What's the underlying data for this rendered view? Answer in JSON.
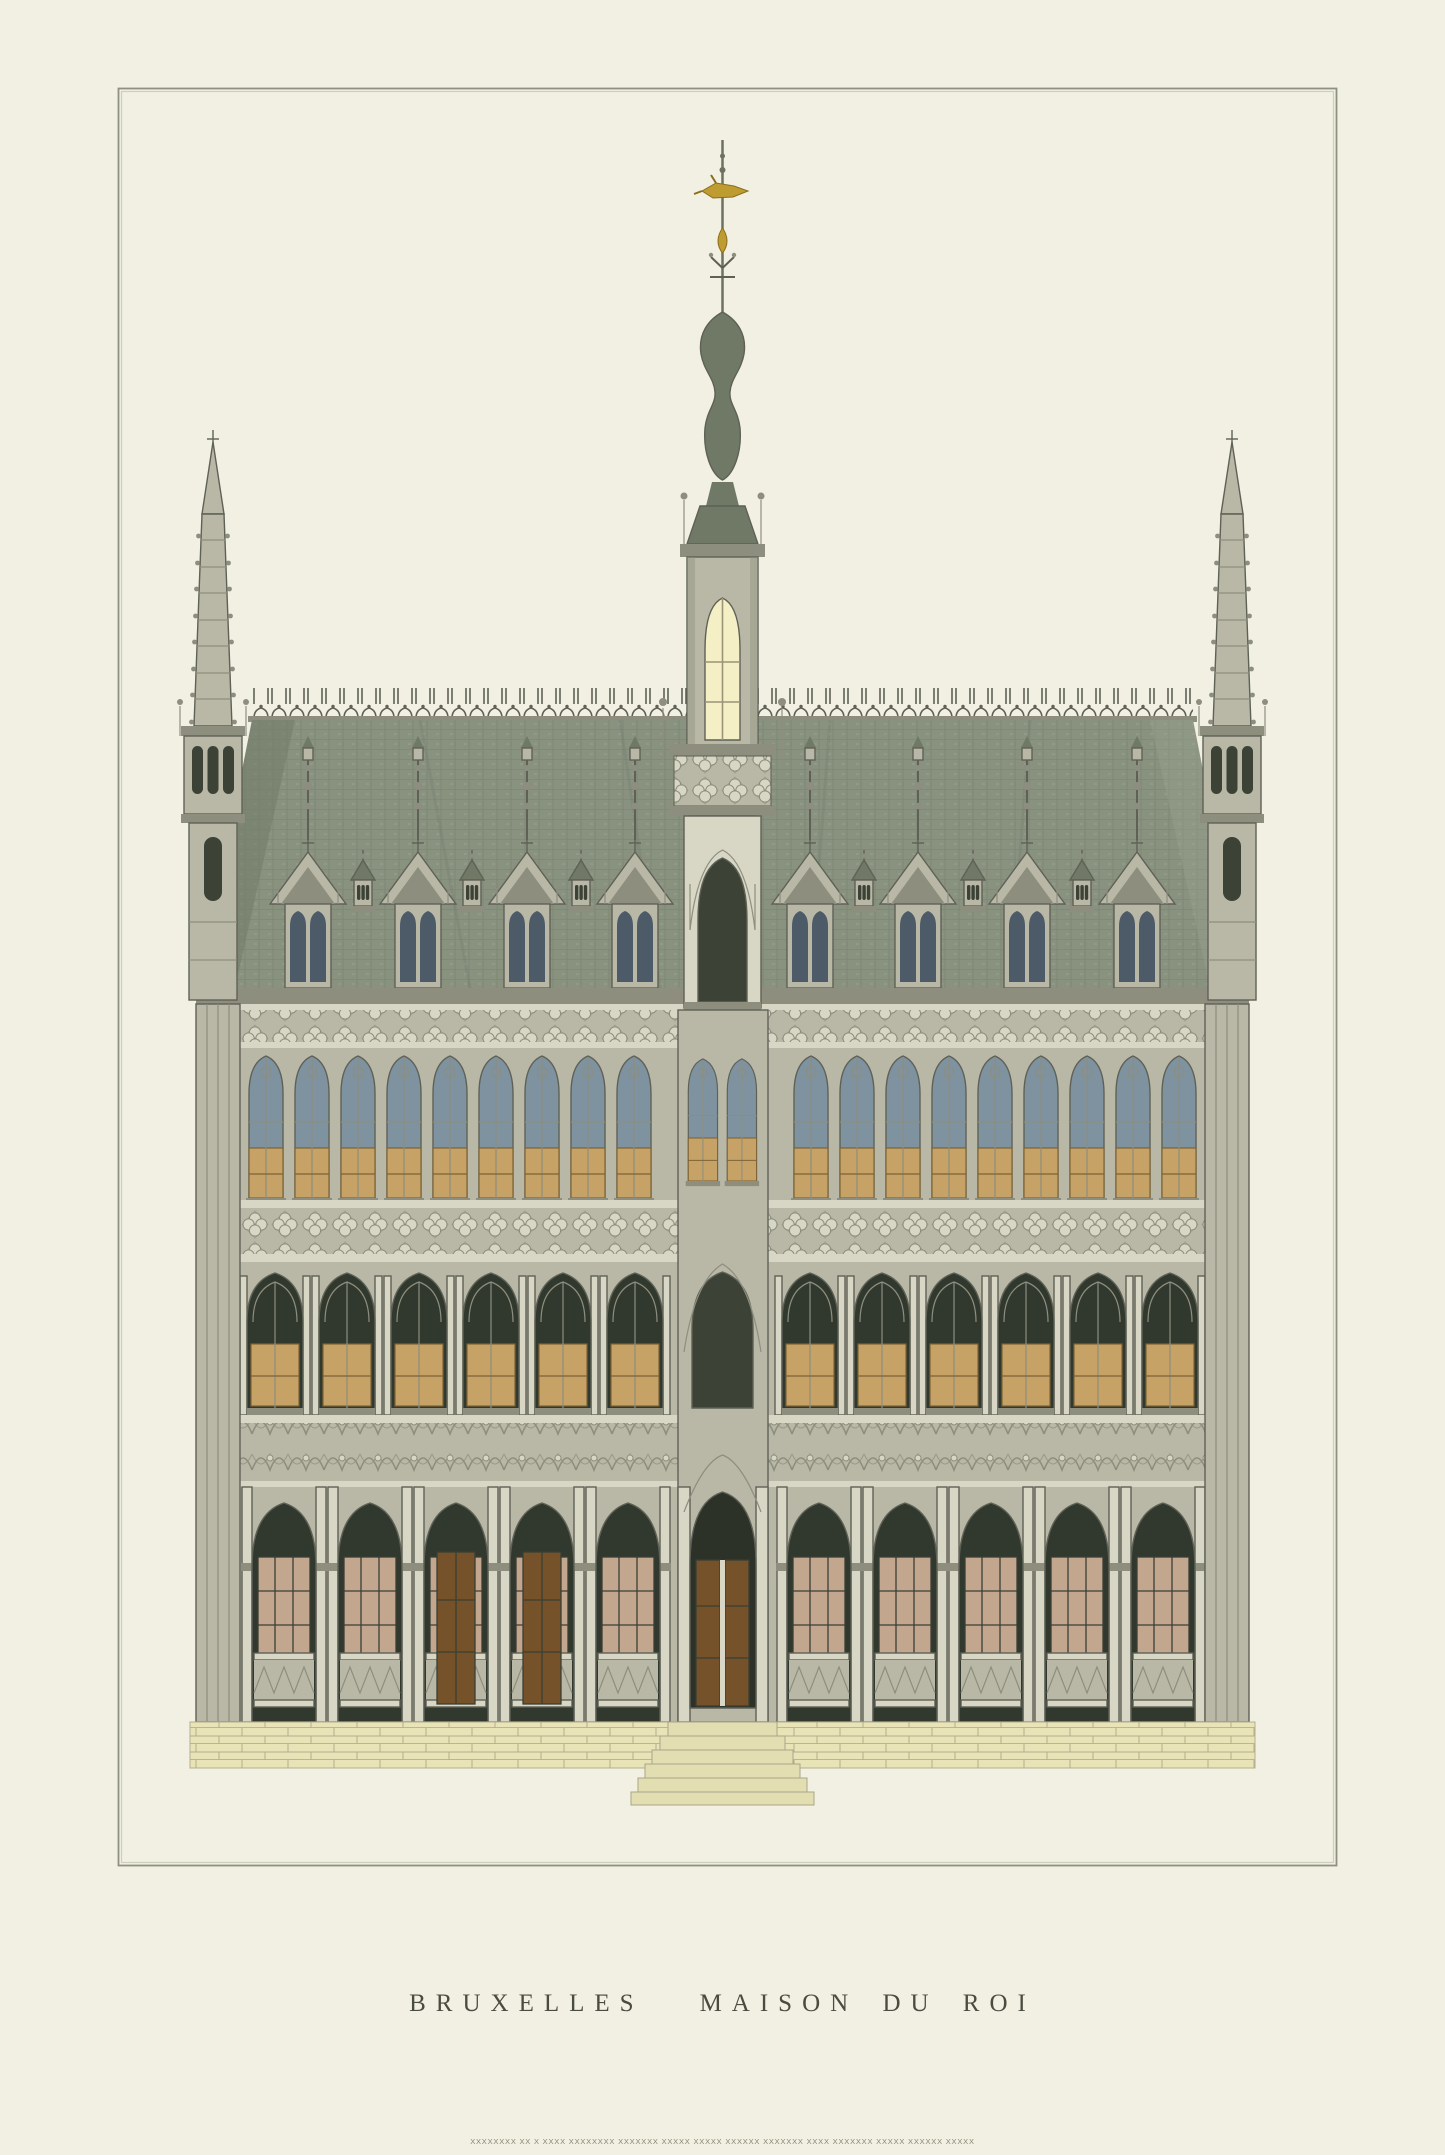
{
  "print": {
    "caption_left": "BRUXELLES",
    "caption_right": "MAISON DU ROI",
    "fine_print_illegible": "XXXXXXXX XX X XXXX XXXXXXXX XXXXXXX XXXXX XXXXX XXXXXX XXXXXXX XXXX XXXXXXX XXXXX XXXXXX XXXXX"
  },
  "colors": {
    "paper": "#f1f0e2",
    "frame_dark": "#8e9080",
    "frame_light": "#cdcfbe",
    "stone": "#b9b8a6",
    "stone_light": "#d8d6c4",
    "stone_dark": "#8d8e7e",
    "stone_line": "#5f6156",
    "window_dark": "#3c4336",
    "glass_dark": "#31382d",
    "glass_blue": "#7e92a0",
    "window_blue": "#4d5a68",
    "panel_tan": "#c6a266",
    "panel_mullion": "#7c6336",
    "pane_pink": "#c3a68e",
    "door_brown": "#76522a",
    "cream_window": "#f5efc5",
    "roof": "#89917f",
    "roof_dark": "#6f7966",
    "roof_light": "#9ba393",
    "plinth": "#e9e3b8",
    "plinth_line": "#b4af8c",
    "gold": "#bf9c2f",
    "ink": "#4b4b41",
    "fine_ink": "#73735f"
  }
}
